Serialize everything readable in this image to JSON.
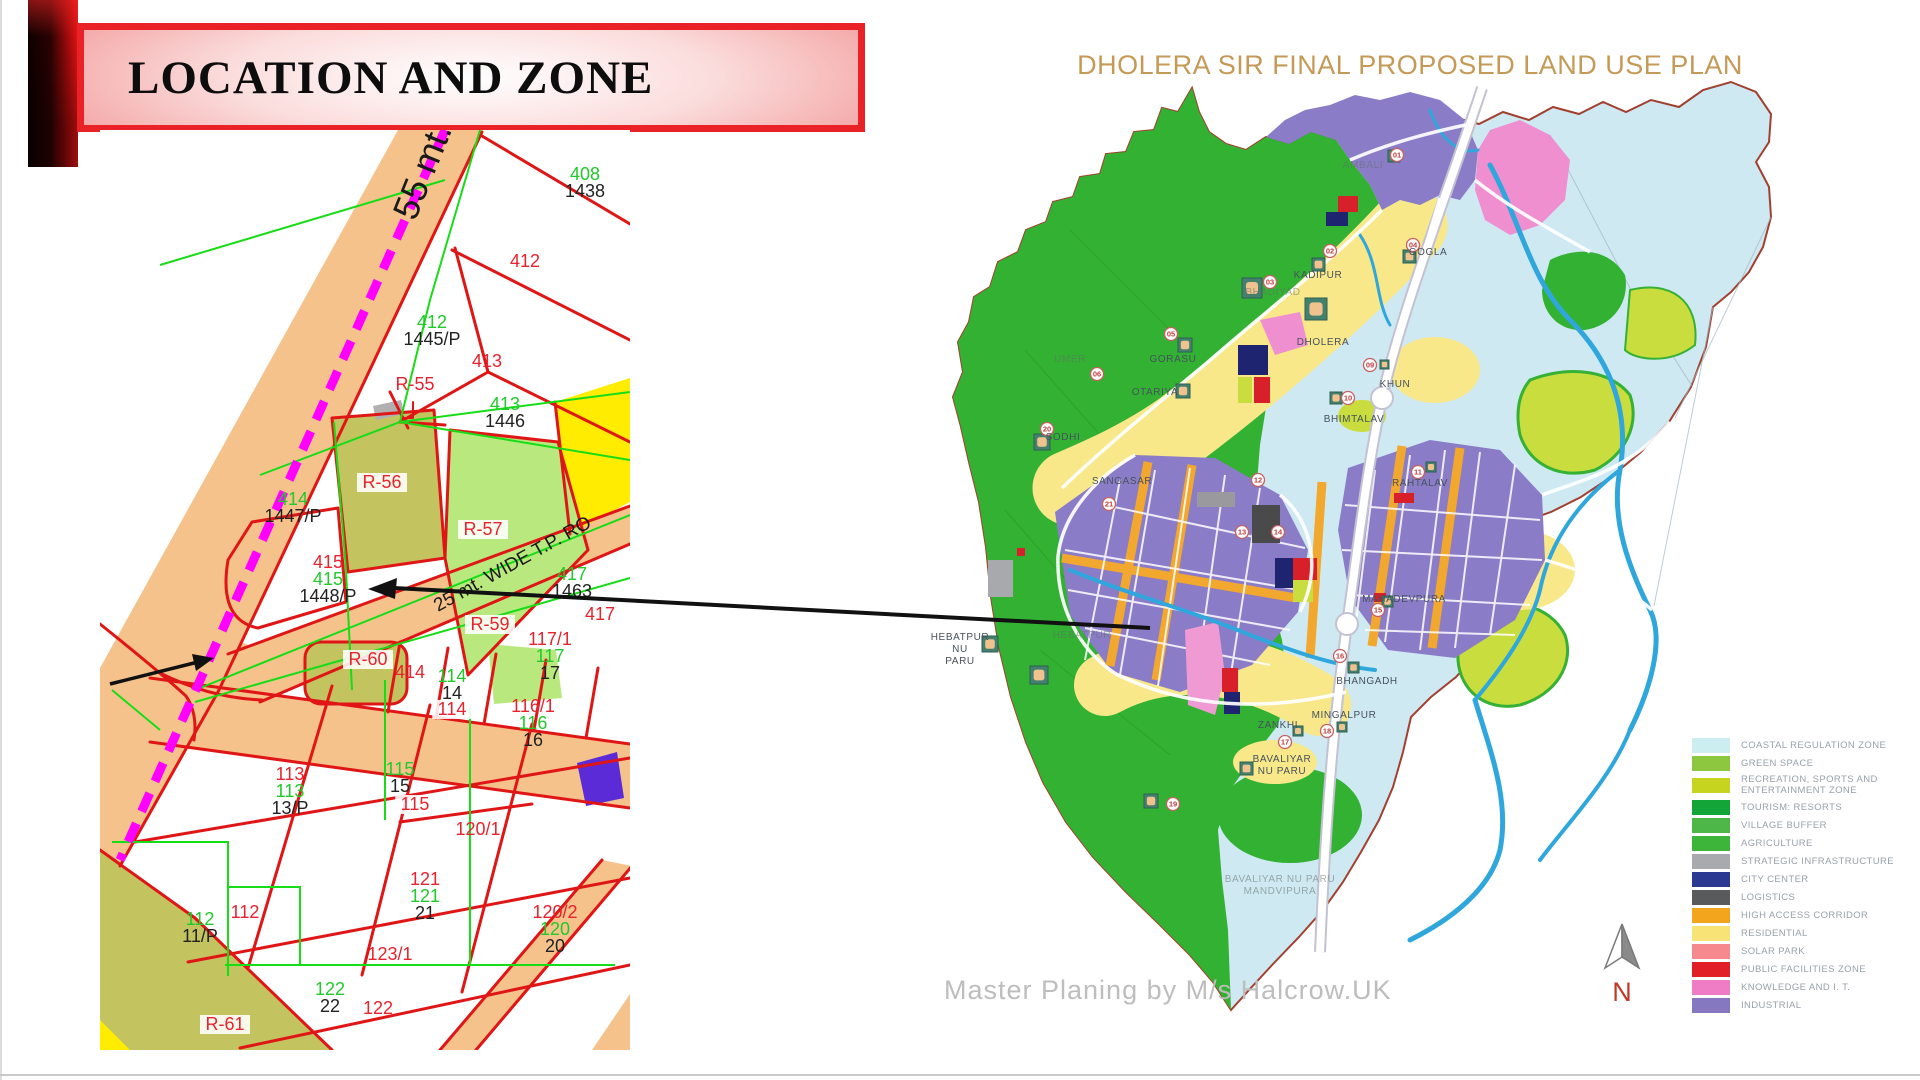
{
  "banner": {
    "title": "LOCATION AND ZONE"
  },
  "colors": {
    "banner_border": "#ea2127",
    "plot_red": "#e8232e",
    "plot_green": "#1fca2a",
    "plot_black": "#222222",
    "road_orange": "#f6c28b",
    "boundary_magenta": "#ff00ff",
    "map_title_gold": "#c59a57"
  },
  "left_map": {
    "label_colors": {
      "r": "#e8232e",
      "g": "#1fca2a",
      "k": "#222222"
    },
    "road_labels": [
      {
        "text": "55 mt.",
        "x": 315,
        "y": 92,
        "rotate": -68,
        "size": 36
      },
      {
        "text": "25 mt. WIDE T.P. RO",
        "x": 338,
        "y": 482,
        "rotate": -29,
        "size": 19
      }
    ],
    "parcels": [
      {
        "x": 485,
        "y": 50,
        "lines": [
          {
            "t": "408",
            "c": "g"
          },
          {
            "t": "1438",
            "c": "k"
          }
        ]
      },
      {
        "x": 425,
        "y": 137,
        "lines": [
          {
            "t": "412",
            "c": "r"
          }
        ]
      },
      {
        "x": 332,
        "y": 198,
        "lines": [
          {
            "t": "412",
            "c": "g"
          },
          {
            "t": "1445/P",
            "c": "k"
          }
        ]
      },
      {
        "x": 387,
        "y": 237,
        "lines": [
          {
            "t": "413",
            "c": "r"
          }
        ]
      },
      {
        "x": 315,
        "y": 260,
        "lines": [
          {
            "t": "R-55",
            "c": "r"
          }
        ]
      },
      {
        "x": 405,
        "y": 280,
        "lines": [
          {
            "t": "413",
            "c": "g"
          },
          {
            "t": "1446",
            "c": "k"
          }
        ]
      },
      {
        "x": 282,
        "y": 358,
        "bg": true,
        "lines": [
          {
            "t": "R-56",
            "c": "r"
          }
        ]
      },
      {
        "x": 193,
        "y": 375,
        "lines": [
          {
            "t": "414",
            "c": "g"
          },
          {
            "t": "1447/P",
            "c": "k"
          }
        ]
      },
      {
        "x": 383,
        "y": 405,
        "bg": true,
        "lines": [
          {
            "t": "R-57",
            "c": "r"
          }
        ]
      },
      {
        "x": 228,
        "y": 438,
        "lines": [
          {
            "t": "415",
            "c": "r"
          },
          {
            "t": "415",
            "c": "g"
          },
          {
            "t": "1448/P",
            "c": "k"
          }
        ]
      },
      {
        "x": 472,
        "y": 450,
        "lines": [
          {
            "t": "417",
            "c": "g"
          },
          {
            "t": "1463",
            "c": "k"
          }
        ]
      },
      {
        "x": 500,
        "y": 490,
        "lines": [
          {
            "t": "417",
            "c": "r"
          }
        ]
      },
      {
        "x": 390,
        "y": 500,
        "bg": true,
        "lines": [
          {
            "t": "R-59",
            "c": "r"
          }
        ]
      },
      {
        "x": 450,
        "y": 515,
        "lines": [
          {
            "t": "117/1",
            "c": "r"
          },
          {
            "t": "117",
            "c": "g"
          },
          {
            "t": "17",
            "c": "k"
          }
        ]
      },
      {
        "x": 268,
        "y": 535,
        "bg": true,
        "lines": [
          {
            "t": "R-60",
            "c": "r"
          }
        ]
      },
      {
        "x": 310,
        "y": 548,
        "lines": [
          {
            "t": "414",
            "c": "r"
          }
        ]
      },
      {
        "x": 352,
        "y": 552,
        "lines": [
          {
            "t": "114",
            "c": "g"
          },
          {
            "t": "14",
            "c": "k"
          }
        ]
      },
      {
        "x": 352,
        "y": 585,
        "bg": true,
        "lines": [
          {
            "t": "114",
            "c": "r"
          }
        ]
      },
      {
        "x": 433,
        "y": 582,
        "lines": [
          {
            "t": "116/1",
            "c": "r"
          },
          {
            "t": "116",
            "c": "g"
          },
          {
            "t": "16",
            "c": "k"
          }
        ]
      },
      {
        "x": 190,
        "y": 650,
        "lines": [
          {
            "t": "113",
            "c": "r"
          },
          {
            "t": "113",
            "c": "g"
          },
          {
            "t": "13/P",
            "c": "k"
          }
        ]
      },
      {
        "x": 300,
        "y": 645,
        "lines": [
          {
            "t": "115",
            "c": "g"
          },
          {
            "t": "15",
            "c": "k"
          }
        ]
      },
      {
        "x": 315,
        "y": 680,
        "bg": true,
        "lines": [
          {
            "t": "115",
            "c": "r"
          }
        ]
      },
      {
        "x": 378,
        "y": 705,
        "lines": [
          {
            "t": "120/1",
            "c": "r"
          }
        ]
      },
      {
        "x": 100,
        "y": 795,
        "lines": [
          {
            "t": "112",
            "c": "g"
          },
          {
            "t": "11/P",
            "c": "k"
          }
        ]
      },
      {
        "x": 145,
        "y": 788,
        "lines": [
          {
            "t": "112",
            "c": "r"
          }
        ]
      },
      {
        "x": 325,
        "y": 755,
        "lines": [
          {
            "t": "121",
            "c": "r"
          },
          {
            "t": "121",
            "c": "g"
          },
          {
            "t": "21",
            "c": "k"
          }
        ]
      },
      {
        "x": 455,
        "y": 788,
        "lines": [
          {
            "t": "120/2",
            "c": "r"
          },
          {
            "t": "120",
            "c": "g"
          },
          {
            "t": "20",
            "c": "k"
          }
        ]
      },
      {
        "x": 290,
        "y": 830,
        "lines": [
          {
            "t": "123/1",
            "c": "r"
          }
        ]
      },
      {
        "x": 230,
        "y": 865,
        "lines": [
          {
            "t": "122",
            "c": "g"
          },
          {
            "t": "22",
            "c": "k"
          }
        ]
      },
      {
        "x": 278,
        "y": 884,
        "lines": [
          {
            "t": "122",
            "c": "r"
          }
        ]
      },
      {
        "x": 125,
        "y": 900,
        "bg": true,
        "lines": [
          {
            "t": "R-61",
            "c": "r"
          }
        ]
      }
    ]
  },
  "right_map": {
    "title": "DHOLERA SIR FINAL PROPOSED LAND USE PLAN",
    "attribution": "Master Planing by M/s Halcrow.UK",
    "north_label": "N",
    "villages": [
      {
        "name": "AMBALI",
        "x": 433,
        "y": 118,
        "faint": true
      },
      {
        "name": "GOGLA",
        "x": 498,
        "y": 205
      },
      {
        "name": "KADIPUR",
        "x": 388,
        "y": 228
      },
      {
        "name": "BHADIYAD",
        "x": 343,
        "y": 245,
        "faint": true
      },
      {
        "name": "DHOLERA",
        "x": 393,
        "y": 295
      },
      {
        "name": "GORASU",
        "x": 243,
        "y": 312
      },
      {
        "name": "OTARIYA",
        "x": 225,
        "y": 345
      },
      {
        "name": "KHUN",
        "x": 465,
        "y": 337
      },
      {
        "name": "BHIMTALAV",
        "x": 424,
        "y": 372
      },
      {
        "name": "UMER",
        "x": 140,
        "y": 312,
        "faint": true
      },
      {
        "name": "SODHI",
        "x": 133,
        "y": 390
      },
      {
        "name": "SANGASAR",
        "x": 192,
        "y": 434
      },
      {
        "name": "RAHTALAV",
        "x": 490,
        "y": 436
      },
      {
        "name": "MAHADEVPURA",
        "x": 474,
        "y": 552
      },
      {
        "name": "HEBATPUR\nNU\nPARU",
        "x": 30,
        "y": 590
      },
      {
        "name": "HEBATPUR",
        "x": 152,
        "y": 588,
        "faint": true
      },
      {
        "name": "BHANGADH",
        "x": 437,
        "y": 634
      },
      {
        "name": "MINGALPUR",
        "x": 414,
        "y": 668
      },
      {
        "name": "ZANKHI",
        "x": 348,
        "y": 678
      },
      {
        "name": "BAVALIYAR\nNU PARU",
        "x": 352,
        "y": 712
      },
      {
        "name": "BAVALIYAR NU PARU\nMANDVIPURA",
        "x": 350,
        "y": 832,
        "faint": true
      }
    ],
    "markers": [
      {
        "n": "01",
        "x": 467,
        "y": 105
      },
      {
        "n": "02",
        "x": 400,
        "y": 201
      },
      {
        "n": "03",
        "x": 340,
        "y": 232
      },
      {
        "n": "04",
        "x": 483,
        "y": 195
      },
      {
        "n": "05",
        "x": 241,
        "y": 284
      },
      {
        "n": "06",
        "x": 167,
        "y": 324
      },
      {
        "n": "09",
        "x": 440,
        "y": 315
      },
      {
        "n": "10",
        "x": 418,
        "y": 348
      },
      {
        "n": "11",
        "x": 488,
        "y": 422
      },
      {
        "n": "12",
        "x": 328,
        "y": 430
      },
      {
        "n": "13",
        "x": 312,
        "y": 482
      },
      {
        "n": "14",
        "x": 348,
        "y": 482
      },
      {
        "n": "15",
        "x": 448,
        "y": 560
      },
      {
        "n": "16",
        "x": 410,
        "y": 606
      },
      {
        "n": "17",
        "x": 355,
        "y": 692
      },
      {
        "n": "18",
        "x": 397,
        "y": 681
      },
      {
        "n": "19",
        "x": 243,
        "y": 754
      },
      {
        "n": "20",
        "x": 117,
        "y": 379
      },
      {
        "n": "21",
        "x": 179,
        "y": 454
      }
    ],
    "icons": [
      {
        "x": 458,
        "y": 100,
        "s": 12
      },
      {
        "x": 473,
        "y": 200,
        "s": 13
      },
      {
        "x": 382,
        "y": 208,
        "s": 13
      },
      {
        "x": 312,
        "y": 228,
        "s": 20
      },
      {
        "x": 375,
        "y": 248,
        "s": 22
      },
      {
        "x": 248,
        "y": 288,
        "s": 14
      },
      {
        "x": 246,
        "y": 334,
        "s": 14
      },
      {
        "x": 104,
        "y": 384,
        "s": 16
      },
      {
        "x": 450,
        "y": 310,
        "s": 9
      },
      {
        "x": 400,
        "y": 342,
        "s": 12
      },
      {
        "x": 496,
        "y": 412,
        "s": 10
      },
      {
        "x": 452,
        "y": 546,
        "s": 11
      },
      {
        "x": 418,
        "y": 612,
        "s": 11
      },
      {
        "x": 407,
        "y": 672,
        "s": 10
      },
      {
        "x": 363,
        "y": 676,
        "s": 10
      },
      {
        "x": 310,
        "y": 712,
        "s": 13
      },
      {
        "x": 52,
        "y": 586,
        "s": 16
      },
      {
        "x": 100,
        "y": 616,
        "s": 18
      },
      {
        "x": 214,
        "y": 744,
        "s": 14
      }
    ],
    "legend": [
      {
        "label": "COASTAL REGULATION ZONE",
        "color": "#cdeef1"
      },
      {
        "label": "GREEN SPACE",
        "color": "#8dc63f"
      },
      {
        "label": "RECREATION, SPORTS AND ENTERTAINMENT ZONE",
        "color": "#c6d420"
      },
      {
        "label": "TOURISM: RESORTS",
        "color": "#13a538"
      },
      {
        "label": "VILLAGE BUFFER",
        "color": "#4db848"
      },
      {
        "label": "AGRICULTURE",
        "color": "#3cb53a"
      },
      {
        "label": "STRATEGIC INFRASTRUCTURE",
        "color": "#a8aaad"
      },
      {
        "label": "CITY CENTER",
        "color": "#2b3990"
      },
      {
        "label": "LOGISTICS",
        "color": "#595a5c"
      },
      {
        "label": "HIGH ACCESS CORRIDOR",
        "color": "#f3a61d"
      },
      {
        "label": "RESIDENTIAL",
        "color": "#f8e476"
      },
      {
        "label": "SOLAR PARK",
        "color": "#f5898d"
      },
      {
        "label": "PUBLIC FACILITIES ZONE",
        "color": "#e01f26"
      },
      {
        "label": "KNOWLEDGE AND I. T.",
        "color": "#ee7dc5"
      },
      {
        "label": "INDUSTRIAL",
        "color": "#8678c0"
      }
    ]
  }
}
